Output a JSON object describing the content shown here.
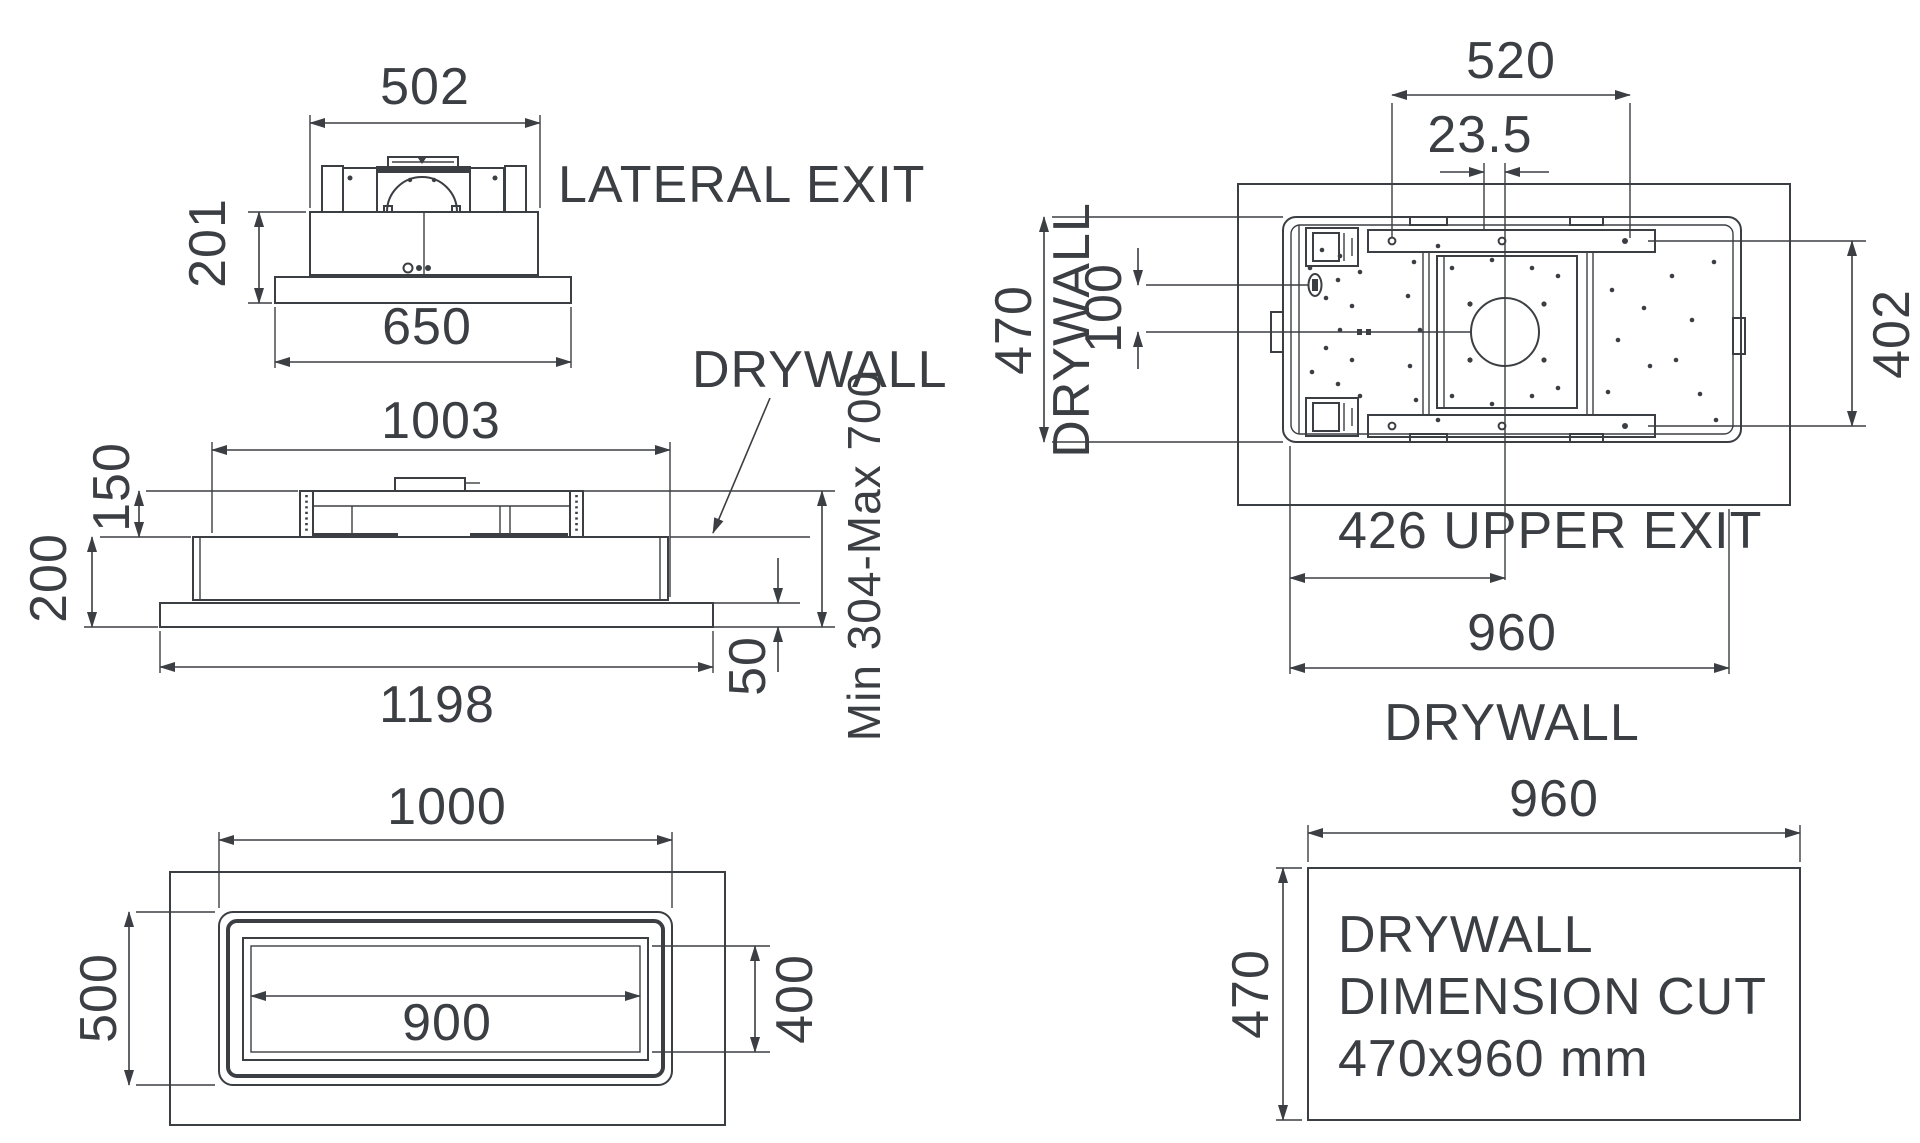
{
  "page": {
    "background": "#ffffff",
    "line_color": "#3b3e42"
  },
  "views": {
    "front": {
      "dims": {
        "top_width": "502",
        "height": "201",
        "base_width": "650"
      },
      "label_exit": "LATERAL EXIT"
    },
    "side": {
      "dims": {
        "top_width": "1003",
        "upper_height": "150",
        "body_height": "200",
        "base_width": "1198",
        "trim_offset": "50",
        "recess_range": "Min 304-Max 700"
      },
      "label_drywall": "DRYWALL"
    },
    "bottom": {
      "dims": {
        "outer_width": "1000",
        "outer_depth": "500",
        "inner_width": "900",
        "inner_depth": "400"
      }
    },
    "top": {
      "dims": {
        "bracket_width": "520",
        "center_offset": "23.5",
        "unit_depth": "470",
        "hole_offset": "100",
        "bracket_span": "402",
        "upper_exit": "426 UPPER EXIT",
        "cut_width": "960"
      },
      "label_drywall_left": "DRYWALL",
      "label_drywall_bottom": "DRYWALL"
    },
    "cut": {
      "dims": {
        "width": "960",
        "height": "470"
      },
      "note_line1": "DRYWALL",
      "note_line2": "DIMENSION CUT",
      "note_line3": "470x960 mm"
    }
  }
}
